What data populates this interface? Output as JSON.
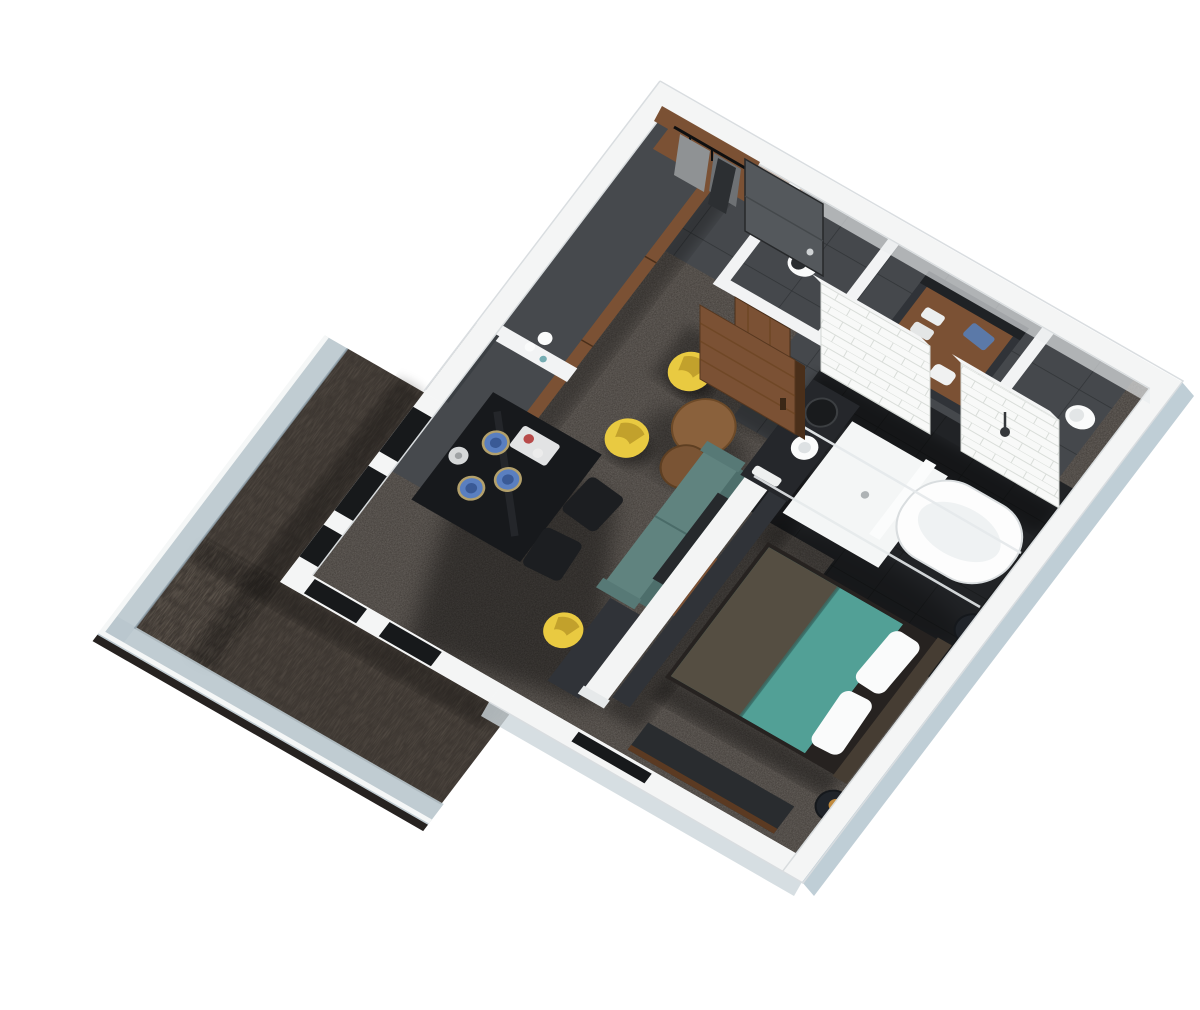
{
  "scene": {
    "type": "architectural-3d-render",
    "description": "Isometric top-down 3D rendering of a studio hotel suite floor plan with balcony, living-dining area, kitchenette, entry hall, WC, bathroom with walk-in shower and freestanding tub, and bedroom",
    "background": "#ffffff",
    "contains_text": false
  },
  "palette": {
    "bg": "#ffffff",
    "wall": "#f4f5f5",
    "wallInner": "#e9edee",
    "wallShade": "#dde1e2",
    "outerFaceSE": "#b4c5cf",
    "outerFaceSW": "#ccd6db",
    "carpet": "#3a3531",
    "tile": "#45484c",
    "grout": "#303336",
    "gloss": "#212326",
    "deck": "#3b3530",
    "deckEdge": "#262220",
    "glass": "#b9c6cd",
    "rail": "#f5f7f7",
    "wood": "#7b5134",
    "woodDark": "#5b3a22",
    "woodEdge": "#4a2f1a",
    "counter": "#46494d",
    "consoleDark": "#303338",
    "black": "#17191c",
    "doorGray": "#54585c",
    "teal": "#479089",
    "tealBright": "#52a096",
    "throwBrown": "#564b3e",
    "headboard": "#463d33",
    "sofa": "#60837f",
    "sofaBack": "#4d6e6b",
    "yellow": "#e9ca41",
    "yellowDark": "#c2a12c",
    "roundTable": "#8a613c",
    "roundTable2": "#7a5434",
    "plate": "#5a7fc0",
    "plateDark": "#3a5a96",
    "tub": "#fdfdfd",
    "tubInner": "#eff2f3",
    "gold": "#c08a3e",
    "nightstand": "#20242a",
    "fixture": "#fafbfb",
    "brick": "#f8f9f8",
    "brickLine": "#d9ddd9",
    "opening": "#17191b",
    "shadow": "#000000"
  },
  "rooms": [
    {
      "name": "balcony",
      "floor": "dark wood deck",
      "features": [
        "glass railing with white top rail",
        "open deck"
      ]
    },
    {
      "name": "entry-hall",
      "floor": "charcoal ceramic tile",
      "features": [
        "dark gray entry door",
        "open closet with black clothes rail",
        "leaning art prints",
        "wood shelf"
      ]
    },
    {
      "name": "kitchenette",
      "floor": "charcoal ceramic tile",
      "features": [
        "long dark counter with wood drawer fronts",
        "wall-mounted dark panel",
        "white sphere lamp",
        "glassware"
      ]
    },
    {
      "name": "wc",
      "floor": "charcoal tile",
      "features": [
        "white toilet",
        "brown sliding wood door",
        "paper holder"
      ]
    },
    {
      "name": "bathroom",
      "floor": "black gloss tile",
      "features": [
        "white subway-tile walls",
        "walk-in shower with glass and chrome rails",
        "shower head",
        "white shower tray",
        "dark vanity with round white basin",
        "round mirror",
        "freestanding white bathtub",
        "second toilet",
        "wardrobe with towels"
      ]
    },
    {
      "name": "living-dining",
      "floor": "dark mottled carpet",
      "features": [
        "black dining table",
        "two black wire chairs",
        "blue plates",
        "silver kettle",
        "white serving tray",
        "two yellow tub chairs",
        "two round wood coffee tables",
        "teal-gray sofa",
        "black floor lamp",
        "work desk with yellow stool",
        "brown pivot door"
      ]
    },
    {
      "name": "bedroom",
      "floor": "dark mottled carpet",
      "features": [
        "double bed with teal duvet and brown throw",
        "white pillows",
        "dark headboard",
        "two round navy nightstands with brass lamps",
        "media console on divider wall",
        "low TV cabinet on outer wall",
        "window slot in wall"
      ]
    }
  ],
  "structure": {
    "walls": "white wall caps seen from above",
    "divider": "white partition wall between living area and bedroom with media panels",
    "window_wall": "white window wall with dark glazing slots facing balcony"
  }
}
